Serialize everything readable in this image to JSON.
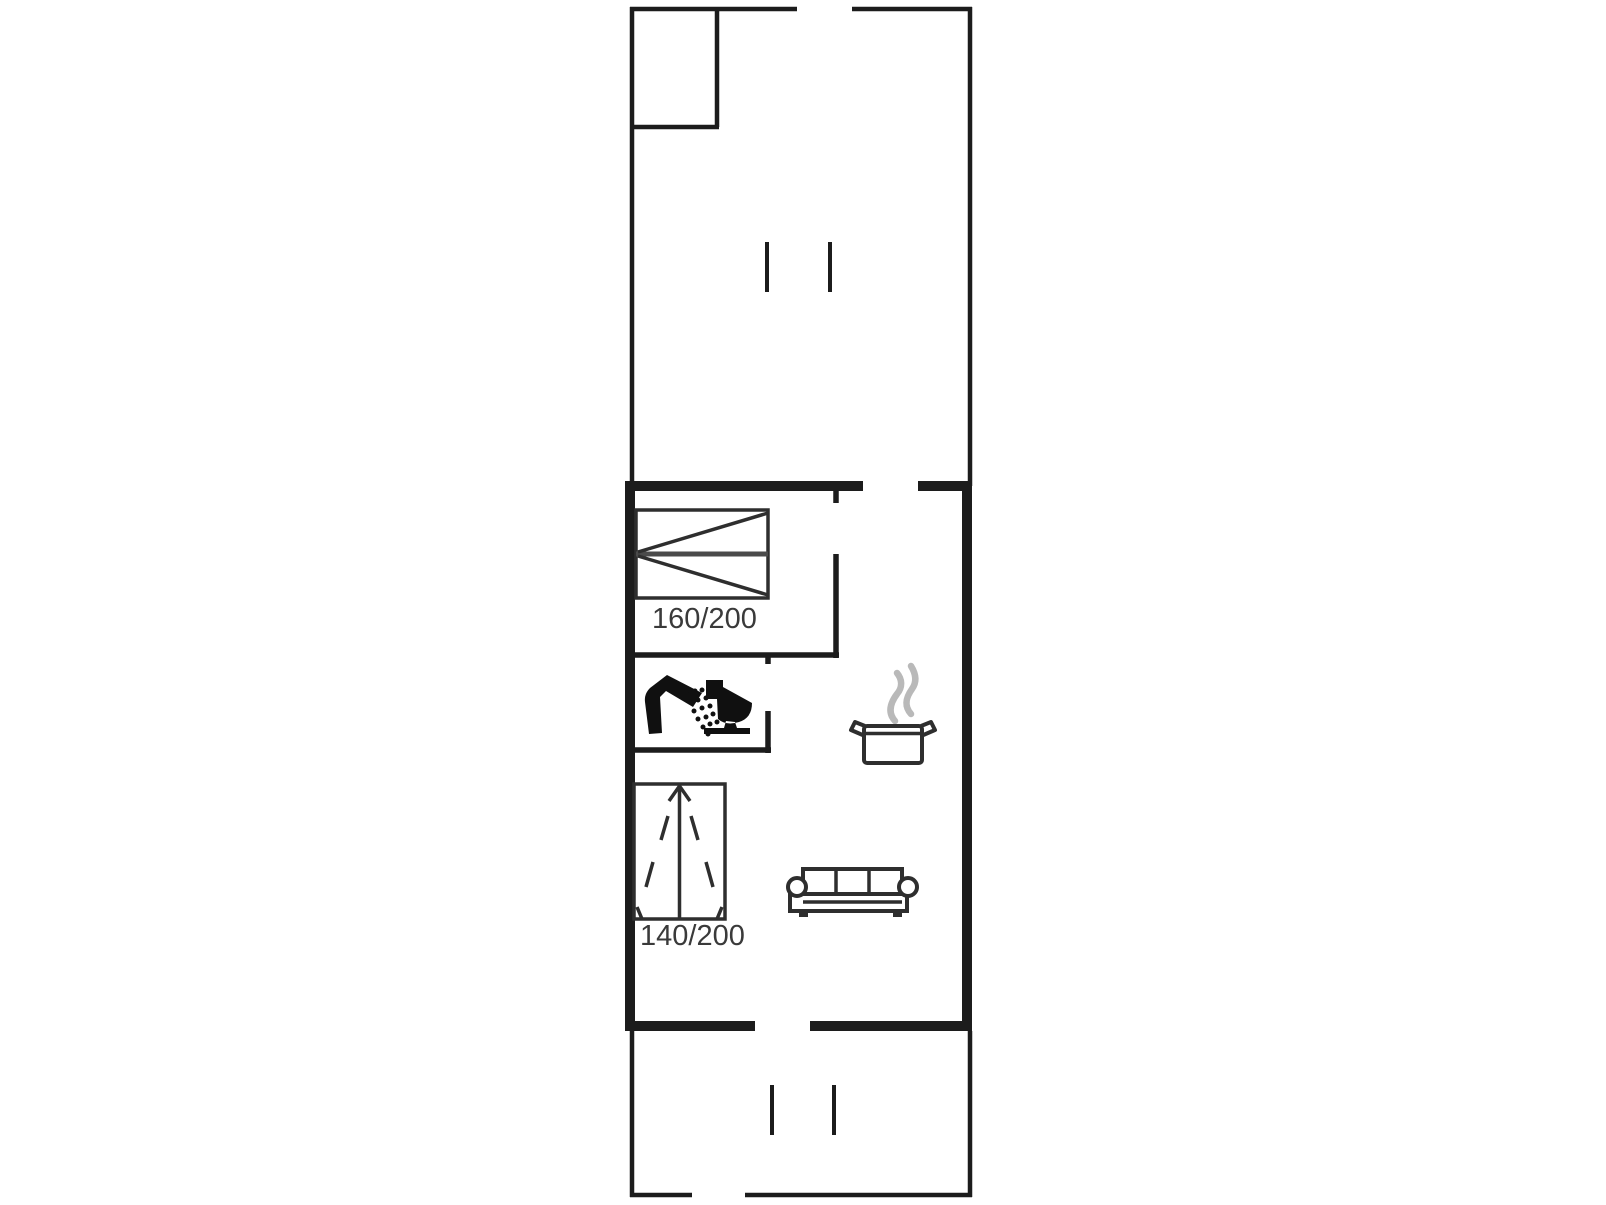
{
  "floorplan": {
    "labels": {
      "bed1_size": "160/200",
      "bed2_size": "140/200"
    },
    "icons": [
      "double-bed-icon",
      "single-duvet-bed-icon",
      "shower-icon",
      "toilet-icon",
      "cooking-pot-icon",
      "steam-icon",
      "sofa-icon",
      "door-opening-tick-icon"
    ],
    "colors": {
      "wall": "#1c1c1c",
      "furniture_outline": "#2e2e2e",
      "icon_black": "#101010",
      "steam_gray": "#b9b9b9",
      "label_text": "#3a3a3a",
      "background": "#ffffff"
    }
  }
}
